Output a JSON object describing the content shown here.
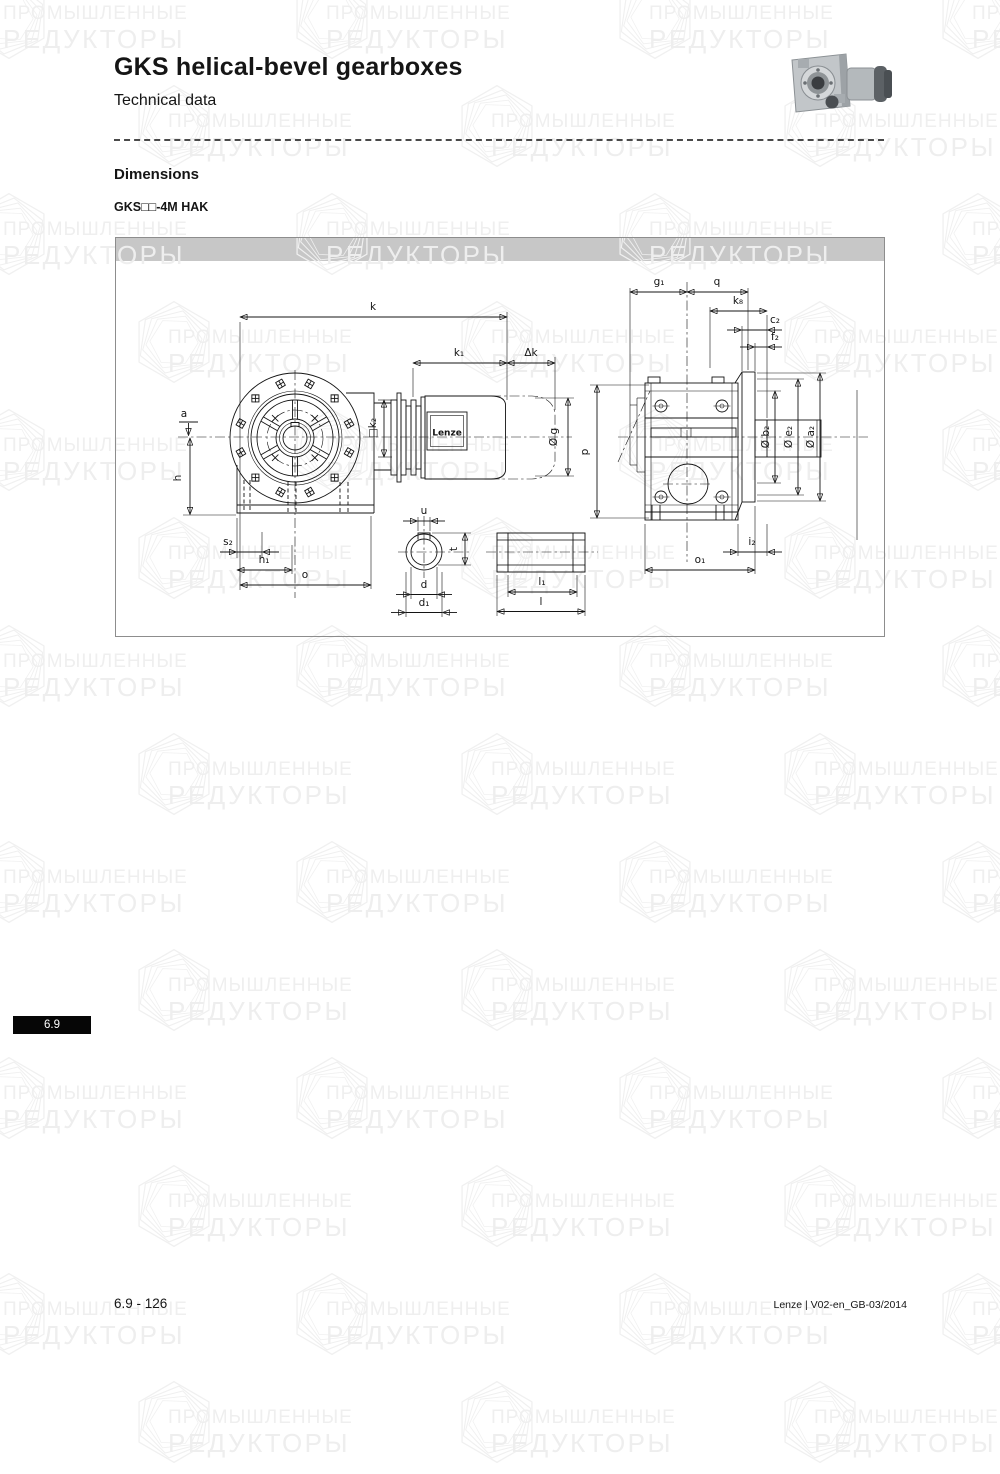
{
  "header": {
    "title": "GKS helical-bevel gearboxes",
    "subtitle": "Technical data"
  },
  "section": {
    "heading": "Dimensions",
    "model": "GKS□□-4M HAK"
  },
  "watermark": {
    "line1": "ПРОМЫШЛЕННЫЕ",
    "line2": "РЕДУКТОРЫ"
  },
  "drawing": {
    "motor_brand": "Lenze",
    "labels": {
      "k": "k",
      "k1": "k₁",
      "dk": "Δk",
      "a": "a",
      "h": "h",
      "s2": "s₂",
      "h1": "h₁",
      "o": "o",
      "k2": "□k₂",
      "g": "Ø g",
      "p": "p",
      "u": "u",
      "t": "t",
      "d": "d",
      "d1": "d₁",
      "l1": "l₁",
      "l": "l",
      "g1": "g₁",
      "q": "q",
      "k8": "k₈",
      "c2": "c₂",
      "f2": "f₂",
      "b2": "Ø b₂",
      "e2": "Ø e₂",
      "a2": "Ø a₂",
      "i2": "i₂",
      "o1": "o₁"
    }
  },
  "sidebar_tab": {
    "label": "6.9"
  },
  "footer": {
    "page": "6.9 - 126",
    "doc": "Lenze | V02-en_GB-03/2014"
  }
}
